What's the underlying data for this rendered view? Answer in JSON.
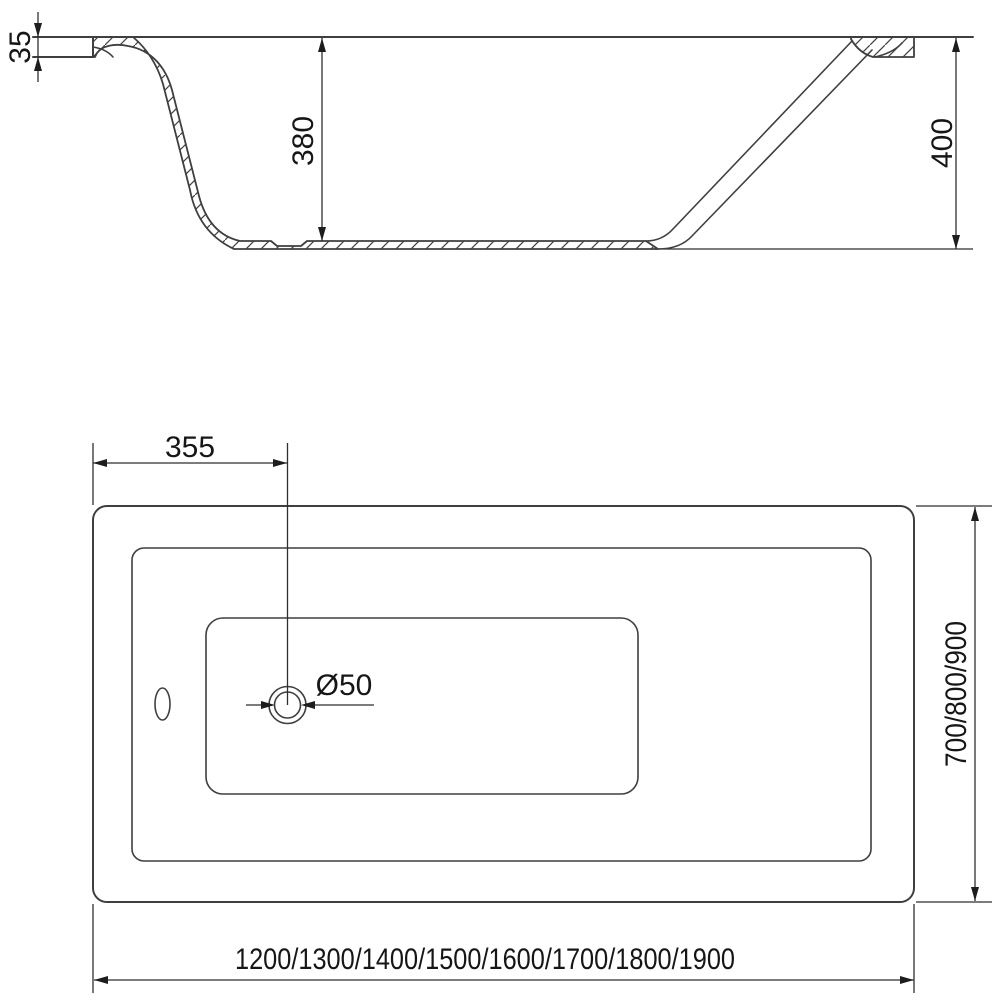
{
  "side_view": {
    "rim_thickness": "35",
    "inner_depth": "380",
    "overall_height": "400"
  },
  "plan_view": {
    "drain_offset": "355",
    "drain_diameter": "Ø50",
    "width_options": "700/800/900",
    "length_options": "1200/1300/1400/1500/1600/1700/1800/1900"
  },
  "colors": {
    "line": "#3f3f3f",
    "dimension_line": "#2f2f2f",
    "text": "#161616",
    "background": "#ffffff"
  }
}
